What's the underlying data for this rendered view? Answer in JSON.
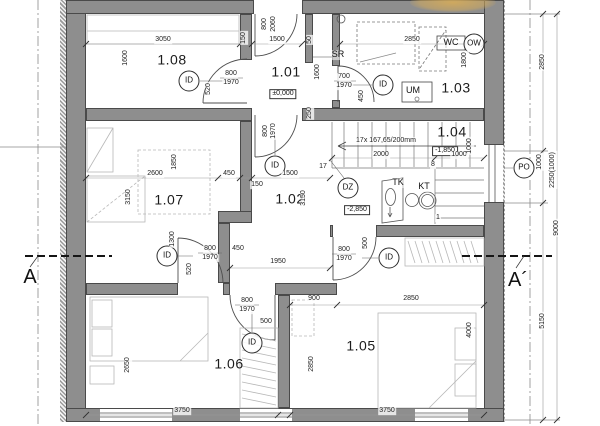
{
  "plan": {
    "type": "architectural-floor-plan",
    "colors": {
      "wall": "#8e8e8e",
      "wall_edge": "#4a4a4a",
      "line": "#555555",
      "furniture": "#b8b8b8",
      "highlight": "#d2aa5c"
    },
    "stairs_note": "17x 167,65/200mm"
  },
  "labels": {
    "rooms": {
      "cls": "room",
      "name": "room-number-label",
      "items": [
        {
          "t": "1.08",
          "x": 172,
          "y": 60
        },
        {
          "t": "1.01",
          "x": 286,
          "y": 72
        },
        {
          "t": "1.03",
          "x": 456,
          "y": 88
        },
        {
          "t": "1.04",
          "x": 452,
          "y": 132
        },
        {
          "t": "1.07",
          "x": 169,
          "y": 200
        },
        {
          "t": "1.02",
          "x": 290,
          "y": 199
        },
        {
          "t": "1.06",
          "x": 229,
          "y": 364
        },
        {
          "t": "1.05",
          "x": 361,
          "y": 346
        }
      ]
    },
    "levels": {
      "cls": "lvl",
      "name": "level-marker",
      "items": [
        {
          "t": "±0,000",
          "x": 283,
          "y": 94
        },
        {
          "t": "-1,850",
          "x": 445,
          "y": 151
        },
        {
          "t": "-2,850",
          "x": 357,
          "y": 210
        }
      ]
    },
    "door_markers": {
      "cls": "circ",
      "name": "door-circle-marker",
      "items": [
        {
          "t": "ID",
          "x": 189,
          "y": 81
        },
        {
          "t": "ID",
          "x": 383,
          "y": 85
        },
        {
          "t": "ID",
          "x": 275,
          "y": 166
        },
        {
          "t": "ID",
          "x": 167,
          "y": 256
        },
        {
          "t": "ID",
          "x": 252,
          "y": 343
        },
        {
          "t": "ID",
          "x": 389,
          "y": 258
        },
        {
          "t": "DZ",
          "x": 348,
          "y": 188
        },
        {
          "t": "PO",
          "x": 524,
          "y": 168
        },
        {
          "t": "OW",
          "x": 474,
          "y": 44
        }
      ]
    },
    "fixtures": {
      "cls": "fix",
      "name": "fixture-label",
      "items": [
        {
          "t": "SR",
          "x": 338,
          "y": 55
        },
        {
          "t": "WC",
          "x": 451,
          "y": 43
        },
        {
          "t": "UM",
          "x": 413,
          "y": 91
        },
        {
          "t": "TK",
          "x": 398,
          "y": 183
        },
        {
          "t": "KT",
          "x": 424,
          "y": 187
        }
      ]
    },
    "sections": {
      "cls": "sec",
      "name": "section-marker-label",
      "items": [
        {
          "t": "A",
          "x": 30,
          "y": 277
        },
        {
          "t": "A´",
          "x": 518,
          "y": 280
        }
      ]
    },
    "dimensions": {
      "cls": "dim",
      "name": "dimension-label",
      "items": [
        {
          "t": "3050",
          "x": 163,
          "y": 40
        },
        {
          "t": "1500",
          "x": 277,
          "y": 40
        },
        {
          "t": "2850",
          "x": 412,
          "y": 40
        },
        {
          "t": "800",
          "x": 265,
          "y": 24,
          "r": 1
        },
        {
          "t": "2060",
          "x": 274,
          "y": 24,
          "r": 1
        },
        {
          "t": "1600",
          "x": 126,
          "y": 58,
          "r": 1
        },
        {
          "t": "1600",
          "x": 318,
          "y": 72,
          "r": 1
        },
        {
          "t": "1800",
          "x": 465,
          "y": 60,
          "r": 1
        },
        {
          "t": "50",
          "x": 310,
          "y": 40,
          "r": 1
        },
        {
          "t": "150",
          "x": 244,
          "y": 38,
          "r": 1
        },
        {
          "t": "800",
          "x": 231,
          "y": 74
        },
        {
          "t": "1970",
          "x": 231,
          "y": 83
        },
        {
          "t": "520",
          "x": 209,
          "y": 89,
          "r": 1
        },
        {
          "t": "700",
          "x": 344,
          "y": 77
        },
        {
          "t": "1970",
          "x": 344,
          "y": 86
        },
        {
          "t": "450",
          "x": 362,
          "y": 96,
          "r": 1
        },
        {
          "t": "250",
          "x": 310,
          "y": 113,
          "r": 1
        },
        {
          "t": "800",
          "x": 266,
          "y": 131,
          "r": 1
        },
        {
          "t": "1970",
          "x": 274,
          "y": 131,
          "r": 1
        },
        {
          "t": "17x 167,65/200mm",
          "x": 386,
          "y": 141
        },
        {
          "t": "2000",
          "x": 381,
          "y": 155
        },
        {
          "t": "1000",
          "x": 459,
          "y": 155
        },
        {
          "t": "1000",
          "x": 470,
          "y": 146,
          "r": 1
        },
        {
          "t": "17",
          "x": 323,
          "y": 167
        },
        {
          "t": "8",
          "x": 433,
          "y": 165
        },
        {
          "t": "1",
          "x": 438,
          "y": 218
        },
        {
          "t": "2600",
          "x": 155,
          "y": 174
        },
        {
          "t": "1850",
          "x": 175,
          "y": 162,
          "r": 1
        },
        {
          "t": "3150",
          "x": 129,
          "y": 197,
          "r": 1
        },
        {
          "t": "450",
          "x": 229,
          "y": 174
        },
        {
          "t": "150",
          "x": 257,
          "y": 185
        },
        {
          "t": "1500",
          "x": 290,
          "y": 174
        },
        {
          "t": "3150",
          "x": 304,
          "y": 198,
          "r": 1
        },
        {
          "t": "1300",
          "x": 173,
          "y": 239,
          "r": 1
        },
        {
          "t": "800",
          "x": 210,
          "y": 249
        },
        {
          "t": "1970",
          "x": 210,
          "y": 258
        },
        {
          "t": "520",
          "x": 190,
          "y": 269,
          "r": 1
        },
        {
          "t": "450",
          "x": 238,
          "y": 249
        },
        {
          "t": "1950",
          "x": 278,
          "y": 262
        },
        {
          "t": "800",
          "x": 344,
          "y": 250
        },
        {
          "t": "1970",
          "x": 344,
          "y": 259
        },
        {
          "t": "500",
          "x": 366,
          "y": 243,
          "r": 1
        },
        {
          "t": "900",
          "x": 314,
          "y": 299
        },
        {
          "t": "2850",
          "x": 411,
          "y": 299
        },
        {
          "t": "800",
          "x": 247,
          "y": 301
        },
        {
          "t": "1970",
          "x": 247,
          "y": 310
        },
        {
          "t": "500",
          "x": 266,
          "y": 322
        },
        {
          "t": "2650",
          "x": 128,
          "y": 365,
          "r": 1
        },
        {
          "t": "2850",
          "x": 312,
          "y": 364,
          "r": 1
        },
        {
          "t": "4000",
          "x": 470,
          "y": 330,
          "r": 1
        },
        {
          "t": "3750",
          "x": 182,
          "y": 411
        },
        {
          "t": "3750",
          "x": 387,
          "y": 411
        },
        {
          "t": "2850",
          "x": 543,
          "y": 62,
          "r": 1
        },
        {
          "t": "1000",
          "x": 540,
          "y": 162,
          "r": 1
        },
        {
          "t": "2250(1000)",
          "x": 553,
          "y": 170,
          "r": 1
        },
        {
          "t": "5150",
          "x": 543,
          "y": 321,
          "r": 1
        },
        {
          "t": "9000",
          "x": 557,
          "y": 228,
          "r": 1
        }
      ]
    }
  }
}
